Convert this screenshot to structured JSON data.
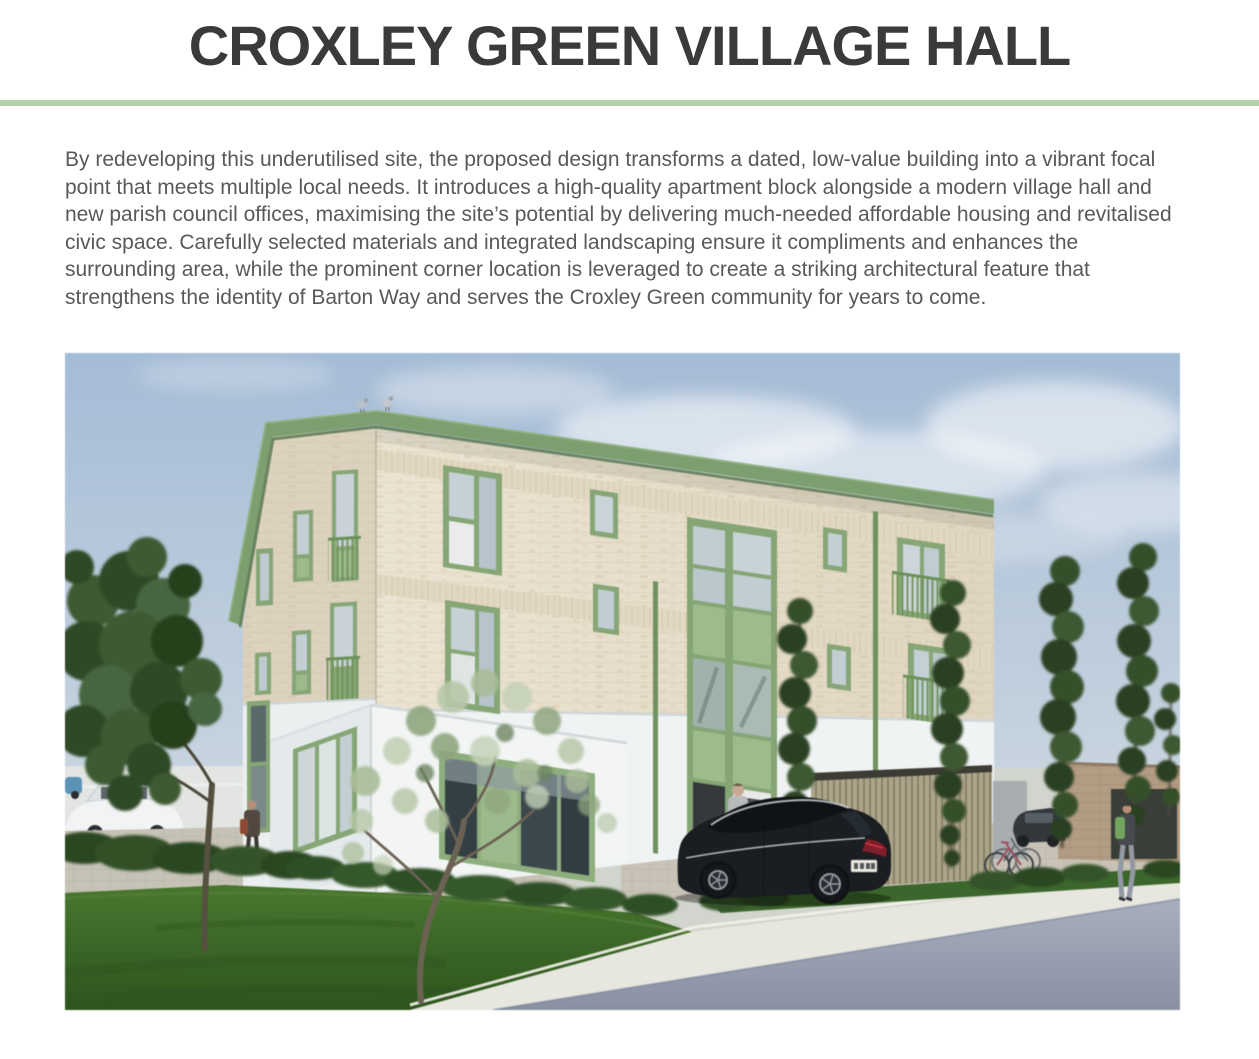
{
  "page": {
    "title": "CROXLEY GREEN VILLAGE HALL",
    "intro": "By redeveloping this underutilised site, the proposed design transforms a dated, low-value building into a vibrant focal point that meets multiple local needs. It introduces a high-quality apartment block alongside a modern village hall and new parish council offices, maximising the site’s potential by delivering much-needed affordable housing and revitalised civic space. Carefully selected materials and integrated landscaping ensure it compliments and enhances the surrounding area, while the prominent corner location is leveraged to create a striking architectural feature that strengthens the identity of Barton Way and serves the Croxley Green community for years to come."
  },
  "theme": {
    "divider_green": "#b2d1a7",
    "title_color": "#3a3a3c",
    "body_text_color": "#58595b",
    "window_green": "#86a676",
    "fascia_green": "#71975f",
    "brick_cream": "#e9e1d0",
    "render_white": "#f0f3f3",
    "sky_blue": "#a9bed6",
    "grass_green": "#38662a",
    "road_grey": "#919aab"
  },
  "figure": {
    "description": "CGI render of the proposed building: three storeys of cream brick with sage green windows and fascia, a white ground-floor village hall wrapping the corner, lawn, trees and shrubs in front, a black car parked by the entrance, timber cycle store, and the street in the foreground under a soft blue sky with two pigeons on the roof."
  }
}
